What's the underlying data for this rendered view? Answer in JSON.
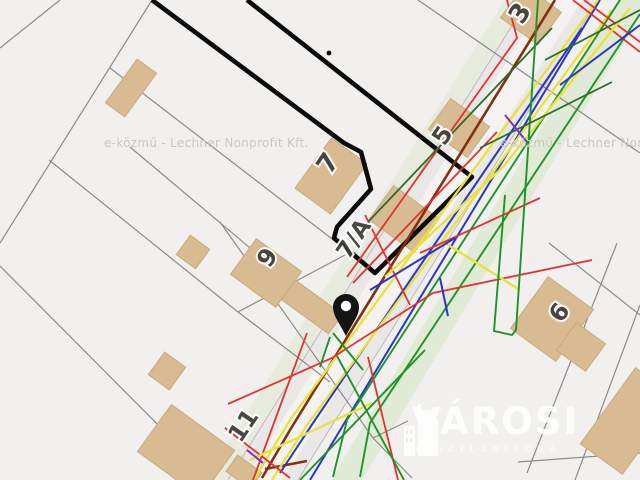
{
  "map": {
    "description": "Hungarian e-közmű cadastral/utility map viewer tile",
    "house_numbers": {
      "n3": "3",
      "n5": "5",
      "n7": "7",
      "n7a": "7/A",
      "n9": "9",
      "n6": "6",
      "n11": "11"
    },
    "watermark": {
      "text": "e-közmű - Lechner Nonprofit Kft."
    },
    "logo": {
      "name": "VÁROSI",
      "tagline": "INGATLANIRODA"
    },
    "colors": {
      "building": "#d8bb90",
      "boundary": "#0c0c0c",
      "red": "#e03333",
      "green": "#1d9427",
      "dgreen": "#2e6b2e",
      "blue": "#2a35cc",
      "yellow": "#e8e23a",
      "brown": "#83300f",
      "violet": "#7733bb",
      "road": "#e9e8e6",
      "background": "#f1f0ee"
    }
  }
}
